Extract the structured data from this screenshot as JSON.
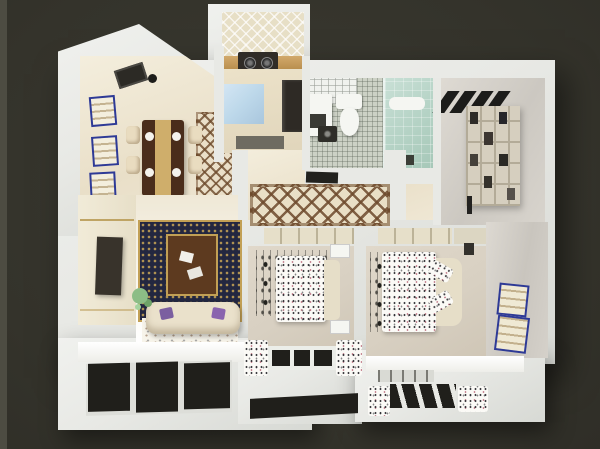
{
  "scene": {
    "type": "3d-apartment-dollhouse-render",
    "view": "top-down cutaway",
    "visible_text": "none",
    "rooms": [
      {
        "name": "entry-dining",
        "furniture": [
          "wall-art-frame",
          "wall-art-frame",
          "wall-art-frame",
          "ceiling-lamp",
          "dining-table",
          "dining-chair x4",
          "plates x4",
          "dining-rug"
        ]
      },
      {
        "name": "kitchen",
        "furniture": [
          "tiled-backsplash",
          "counter",
          "stove-two-burners",
          "blue-island-counter",
          "fridge-cabinet",
          "doormat"
        ]
      },
      {
        "name": "bathroom",
        "furniture": [
          "ceiling-tile-grid",
          "vanity",
          "toilet",
          "washing-machine",
          "mosaic-floor",
          "teal-shower",
          "towel",
          "bath-mat"
        ]
      },
      {
        "name": "study",
        "furniture": [
          "black-stripe-decor",
          "bookshelf-with-books",
          "floor-lamp-bar"
        ]
      },
      {
        "name": "hallway",
        "furniture": [
          "lattice-runner-rug",
          "ceiling-vent"
        ]
      },
      {
        "name": "living-room",
        "furniture": [
          "tv-wall-panel",
          "television",
          "ornate-navy-gold-rug",
          "brown-coffee-table",
          "papers x2",
          "cream-sofa",
          "purple-pillows x2",
          "plant"
        ]
      },
      {
        "name": "balcony",
        "furniture": [
          "dark-glass-windows"
        ]
      },
      {
        "name": "second-bedroom",
        "furniture": [
          "closet",
          "bead-curtain-decor",
          "speckled-bed",
          "headboard",
          "nightstand x2",
          "window",
          "speckled-curtains x2"
        ]
      },
      {
        "name": "master-bedroom",
        "furniture": [
          "closet",
          "bead-curtain-decor",
          "speckled-bed",
          "headboard",
          "pillows x2",
          "wall-art-frame x2",
          "bay-window",
          "speckled-curtains x2"
        ]
      }
    ]
  },
  "palette": {
    "bg": "#34332b",
    "bg2": "#3a3931",
    "bg-edge": "#4d4c42",
    "wall": "#e8e9e5",
    "floor-cream": "#efe8d6",
    "floor-tan": "#d8d0c2",
    "marble": "#d9d5ce",
    "frame-blue": "#2e3a96",
    "rug-navy": "#232740",
    "rug-gold": "#c2a055",
    "rug-brown": "#5d3a1f",
    "sofa": "#eae1cb",
    "pillow-purple": "#7b5fa0",
    "teal": "#b7d4c7",
    "wood": "#c8a468",
    "counter-blue": "#bdd8ea",
    "fixture-dark": "#2c2a25",
    "glass-dark": "#201f1b",
    "plant-green": "#8cbd86",
    "mosaic": "#ccd1c5",
    "lattice-brown": "#6d4a2c"
  }
}
